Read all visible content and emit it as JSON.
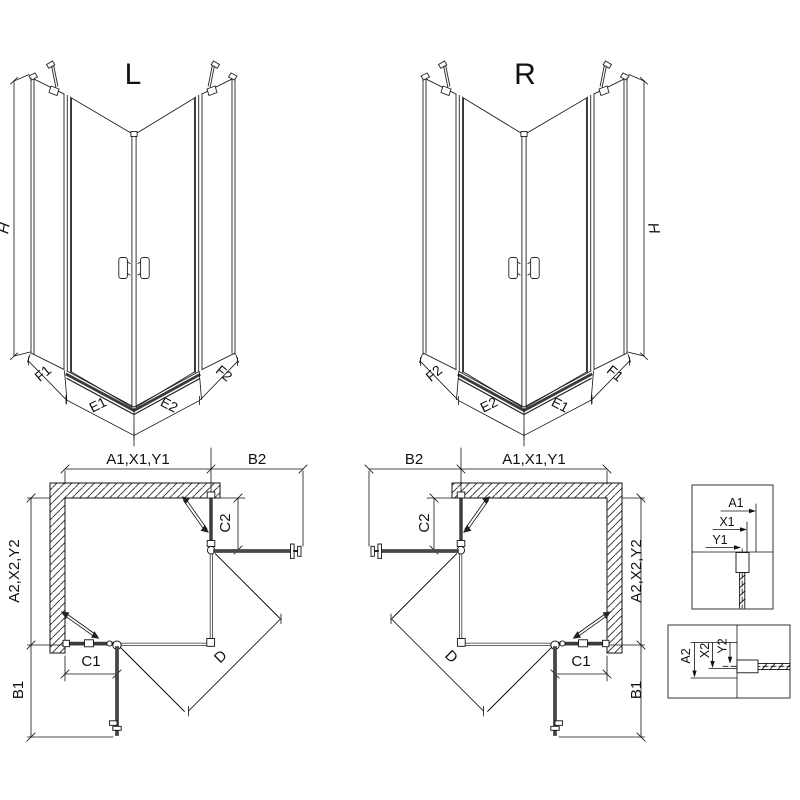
{
  "drawing": {
    "iso_left": {
      "label": "L",
      "h": "H",
      "f1": "F1",
      "e1": "E1",
      "e2": "E2",
      "f2": "F2"
    },
    "iso_right": {
      "label": "R",
      "h": "H",
      "f1": "F1",
      "e1": "E1",
      "e2": "E2",
      "f2": "F2"
    },
    "plan_left": {
      "a1": "A1,X1,Y1",
      "b2": "B2",
      "a2": "A2,X2,Y2",
      "b1": "B1",
      "c1": "C1",
      "c2": "C2",
      "d": "D"
    },
    "plan_right": {
      "a1": "A1,X1,Y1",
      "b2": "B2",
      "a2": "A2,X2,Y2",
      "b1": "B1",
      "c1": "C1",
      "c2": "C2",
      "d": "D"
    },
    "detail_top": {
      "a1": "A1",
      "x1": "X1",
      "y1": "Y1"
    },
    "detail_bottom": {
      "a2": "A2",
      "x2": "X2",
      "y2": "Y2"
    }
  },
  "colors": {
    "line": "#1a1a1a",
    "glass": "#3a3a3a",
    "panel_bar": "#474747",
    "background": "#ffffff"
  }
}
